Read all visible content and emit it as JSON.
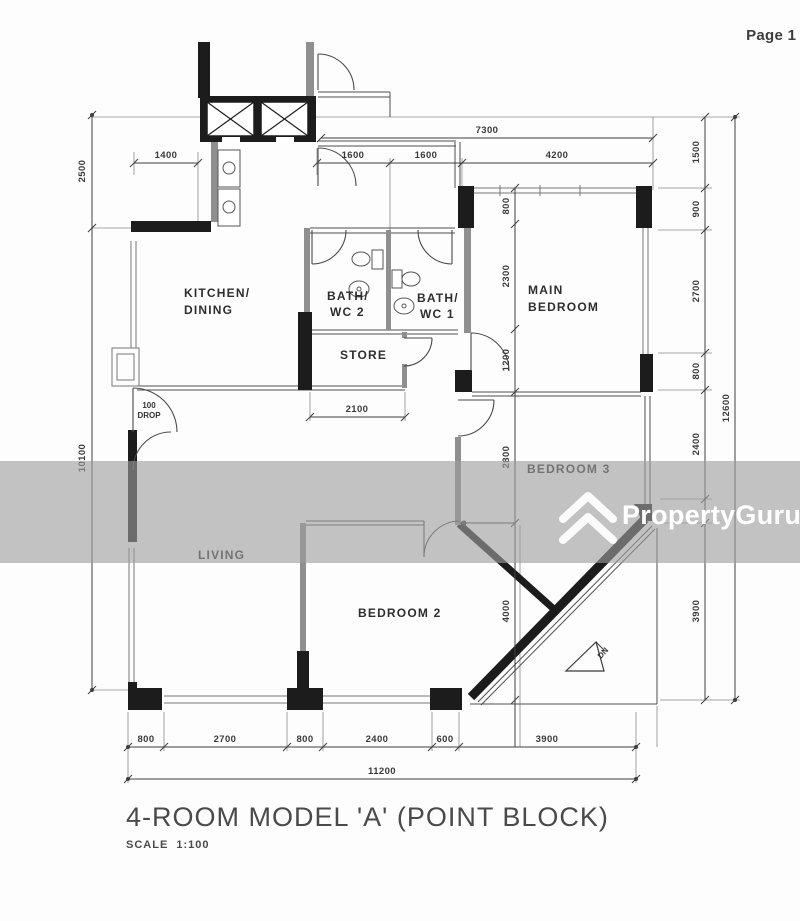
{
  "page": {
    "label": "Page 1 ("
  },
  "watermark": {
    "brand": "PropertyGuru"
  },
  "title": {
    "main": "4-ROOM MODEL 'A' (POINT BLOCK)",
    "scale": "SCALE  1:100"
  },
  "rooms": {
    "kitchen1": "KITCHEN/",
    "kitchen2": "DINING",
    "bath2a": "BATH/",
    "bath2b": "WC 2",
    "bath1a": "BATH/",
    "bath1b": "WC 1",
    "store": "STORE",
    "main1": "MAIN",
    "main2": "BEDROOM",
    "bedroom3": "BEDROOM 3",
    "living": "LIVING",
    "bedroom2": "BEDROOM 2"
  },
  "dims": {
    "top": {
      "overall": "7300",
      "kitchen": "1400",
      "bath2": "1600",
      "bath1": "1600",
      "main": "4200"
    },
    "right": {
      "a": "1500",
      "b": "900",
      "c": "2700",
      "d": "800",
      "e": "2400",
      "f": "3900",
      "overall": "12600"
    },
    "left": {
      "a": "2500",
      "b": "10100"
    },
    "bottom": {
      "a": "800",
      "b": "2700",
      "c": "800",
      "d": "2400",
      "e": "600",
      "f": "3900",
      "overall": "11200"
    },
    "inner": {
      "a": "800",
      "b": "2300",
      "c": "1200",
      "d": "2800",
      "e": "4000",
      "store": "2100",
      "drop1": "100",
      "drop2": "DROP",
      "dn": "DN"
    }
  }
}
